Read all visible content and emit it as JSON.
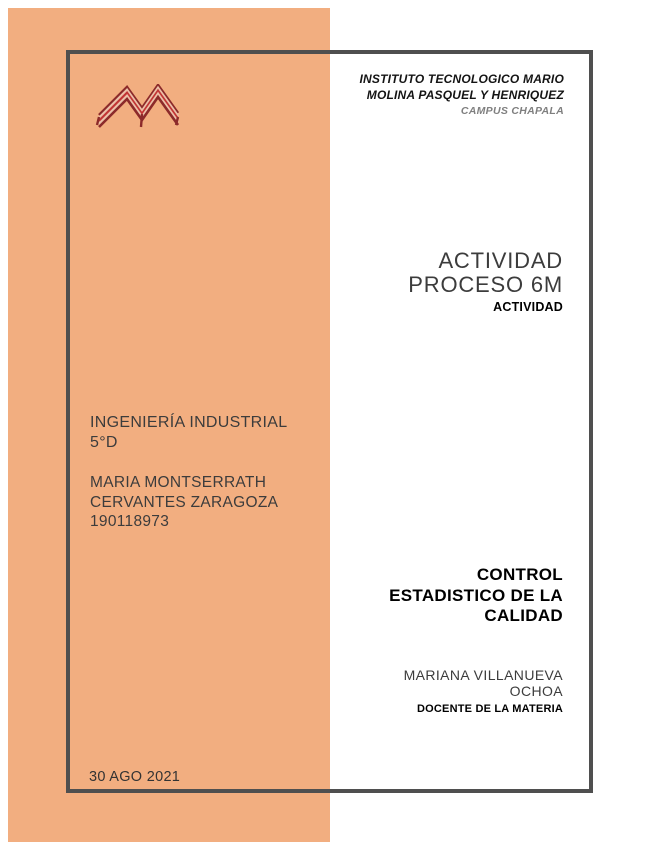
{
  "theme": {
    "page_bg": "#ffffff",
    "accent": "#f2ae80",
    "frame_border": "#4f4f4f",
    "text_dark": "#3c3c3c",
    "text_black": "#141414",
    "text_gray": "#7f7f7f",
    "logo_dark_red": "#8c2a2a",
    "logo_red": "#c23535",
    "logo_light": "#ecc0a8"
  },
  "header": {
    "institute_line1": "INSTITUTO TECNOLOGICO MARIO",
    "institute_line2": "MOLINA PASQUEL Y HENRIQUEZ",
    "campus": "CAMPUS CHAPALA"
  },
  "logo": {
    "name": "instituto-tecnologico-m-logo"
  },
  "title": {
    "line1": "ACTIVIDAD",
    "line2": "PROCESO 6M",
    "subtitle": "ACTIVIDAD"
  },
  "student": {
    "program": "INGENIERÍA INDUSTRIAL",
    "group": "5°D",
    "name_line1": "MARIA MONTSERRATH",
    "name_line2": "CERVANTES ZARAGOZA",
    "student_id": "190118973"
  },
  "course": {
    "line1": "CONTROL",
    "line2": "ESTADISTICO DE LA",
    "line3": "CALIDAD"
  },
  "teacher": {
    "name_line1": "MARIANA VILLANUEVA",
    "name_line2": "OCHOA",
    "role": "DOCENTE DE LA MATERIA"
  },
  "date": "30 AGO 2021"
}
